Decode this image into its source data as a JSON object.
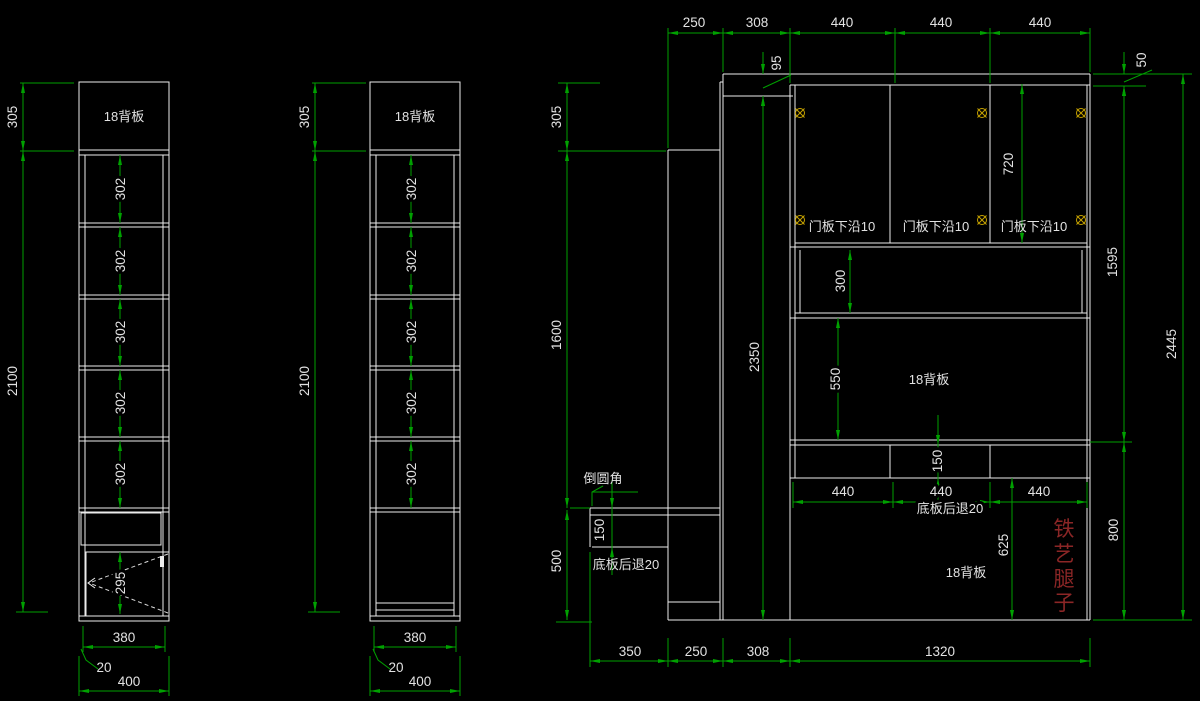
{
  "colors": {
    "background": "#000000",
    "structure_lines": "#ececec",
    "dimension_green": "#00a000",
    "hinge_yellow": "#c8a400",
    "legs_red": "#8b2626"
  },
  "left_view": {
    "back_panel": "18背板",
    "top_height": "305",
    "total_height": "2100",
    "shelves": [
      "302",
      "302",
      "302",
      "302",
      "302"
    ],
    "door_height": "295",
    "inner_width": "380",
    "side_gap": "20",
    "outer_width": "400"
  },
  "middle_view": {
    "back_panel": "18背板",
    "top_height": "305",
    "total_height": "2100",
    "shelves": [
      "302",
      "302",
      "302",
      "302",
      "302"
    ],
    "inner_width": "380",
    "side_gap": "20",
    "outer_width": "400"
  },
  "elevation": {
    "top_widths": [
      "250",
      "308",
      "440",
      "440",
      "440"
    ],
    "crown_height": "95",
    "top_rail_height": "50",
    "left_top_height": "305",
    "left_mid_height": "1600",
    "left_bottom_height": "500",
    "inner_height": "2350",
    "door_notes": [
      "门板下沿10",
      "门板下沿10",
      "门板下沿10"
    ],
    "door_height": "720",
    "niche_height": "300",
    "upper_back_panel": "18背板",
    "upper_back_height": "550",
    "shelf_band_height": "150",
    "mid_widths": [
      "440",
      "440",
      "440"
    ],
    "mid_recess_note": "底板后退20",
    "lower_back_panel": "18背板",
    "lower_height": "625",
    "right_upper_height": "1595",
    "right_total_height": "2445",
    "right_lower_height": "800",
    "desk_corner_note": "倒圆角",
    "desk_height": "150",
    "desk_recess_note": "底板后退20",
    "iron_legs_label": "铁艺腿子",
    "iron_legs_chars": [
      "铁",
      "艺",
      "腿",
      "子"
    ],
    "bottom_widths": [
      "350",
      "250",
      "308",
      "1320"
    ]
  }
}
